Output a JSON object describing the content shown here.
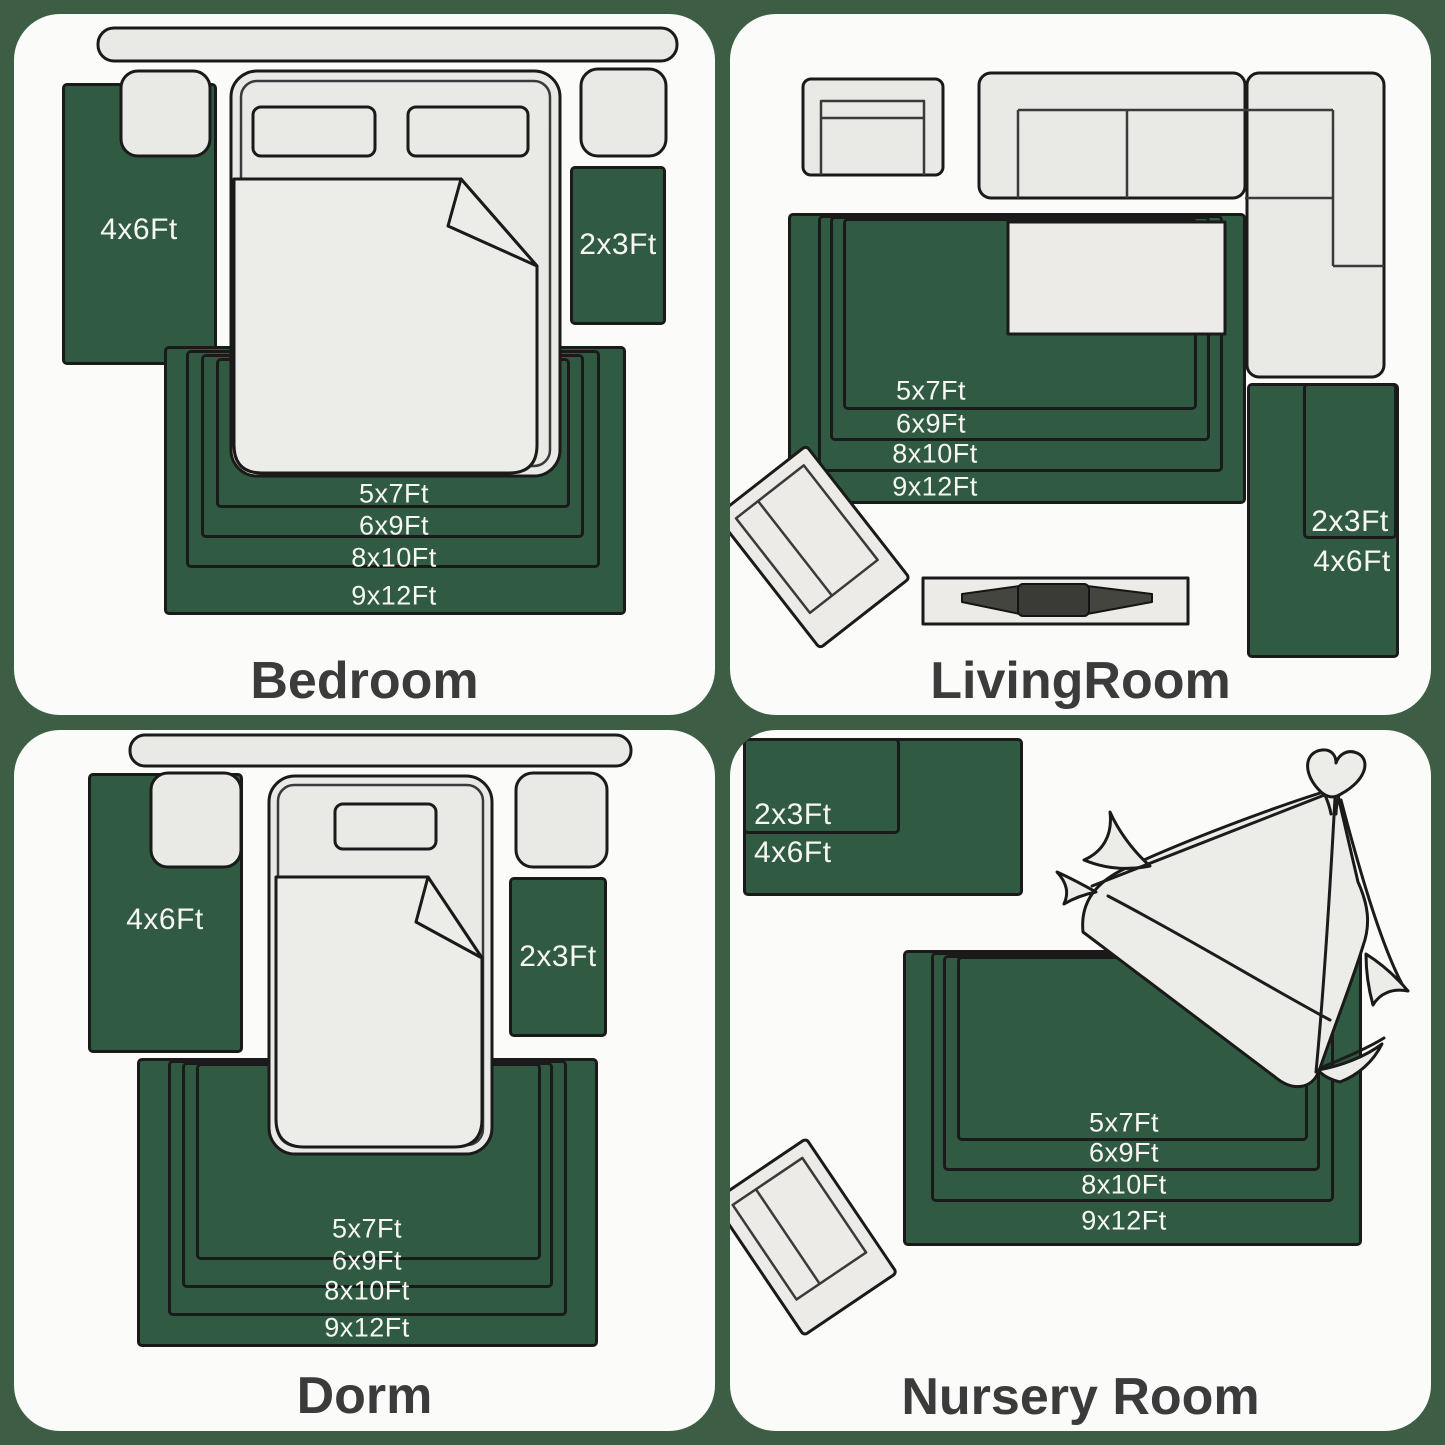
{
  "colors": {
    "page_background": "#3d5e45",
    "panel_background": "#fbfbf9",
    "rug_green": "#305b42",
    "outline": "#1a1a1a",
    "furniture_gray": "#e9e9e6",
    "label_text": "#f6f6f3",
    "title_text": "#3b3b3b"
  },
  "panels": [
    {
      "title": "Bedroom",
      "left_rug_label": "4x6Ft",
      "right_rug_label": "2x3Ft",
      "nested_labels": [
        "5x7Ft",
        "6x9Ft",
        "8x10Ft",
        "9x12Ft"
      ]
    },
    {
      "title": "LivingRoom",
      "nested_labels": [
        "5x7Ft",
        "6x9Ft",
        "8x10Ft",
        "9x12Ft"
      ],
      "runner_labels": [
        "2x3Ft",
        "4x6Ft"
      ]
    },
    {
      "title": "Dorm",
      "left_rug_label": "4x6Ft",
      "right_rug_label": "2x3Ft",
      "nested_labels": [
        "5x7Ft",
        "6x9Ft",
        "8x10Ft",
        "9x12Ft"
      ]
    },
    {
      "title": "Nursery Room",
      "corner_rug_labels": [
        "2x3Ft",
        "4x6Ft"
      ],
      "nested_labels": [
        "5x7Ft",
        "6x9Ft",
        "8x10Ft",
        "9x12Ft"
      ]
    }
  ]
}
